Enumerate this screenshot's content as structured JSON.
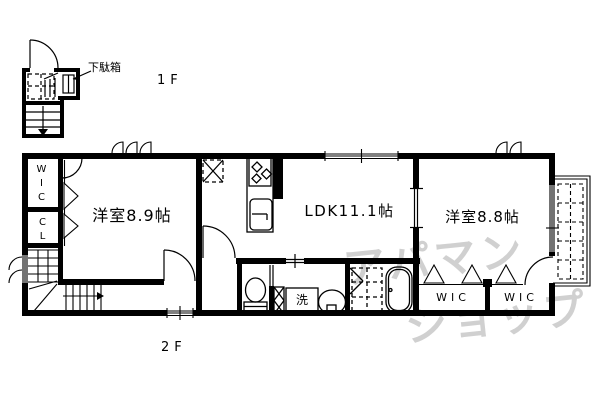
{
  "labels": {
    "floor1": "1F",
    "floor2": "2F",
    "shoe_cabinet": "下駄箱",
    "bedroom_left": "洋室8.9帖",
    "ldk": "LDK11.1帖",
    "bedroom_right": "洋室8.8帖",
    "wic_vertical": "WIC",
    "closet_vertical": "CL",
    "wic_bottom_left": "WIC",
    "wic_bottom_right": "WIC",
    "laundry": "洗"
  },
  "watermark": {
    "line1": "アパマン",
    "line2": "ショップ",
    "color": "#c8c8c8"
  },
  "colors": {
    "line": "#000000",
    "background": "#ffffff"
  }
}
